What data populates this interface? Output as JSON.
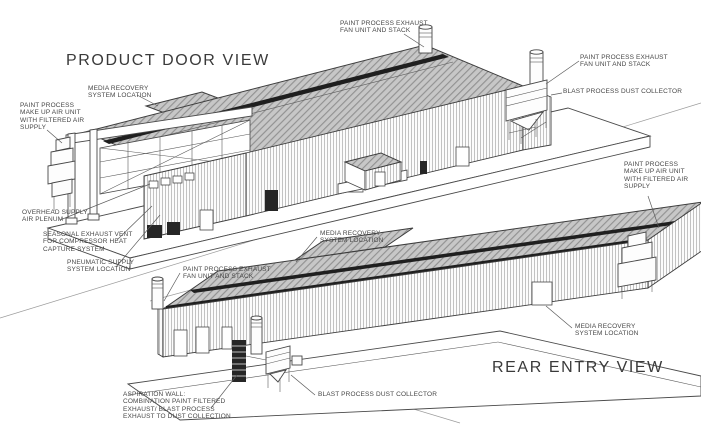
{
  "colors": {
    "background": "#ffffff",
    "line": "#4a4a4a",
    "roof_fill": "#c7c7c7",
    "ridge_band": "#1f1f1f",
    "label_text": "#474747"
  },
  "product_door_view": {
    "title": "PRODUCT DOOR VIEW",
    "labels": {
      "exhaust_fan_top": "PAINT PROCESS EXHAUST\nFAN UNIT AND STACK",
      "exhaust_fan_right": "PAINT PROCESS EXHAUST\nFAN UNIT AND STACK",
      "dust_collector": "BLAST PROCESS DUST COLLECTOR",
      "media_recovery": "MEDIA RECOVERY\nSYSTEM LOCATION",
      "make_up_air": "PAINT PROCESS\nMAKE UP AIR UNIT\nWITH FILTERED AIR\nSUPPLY",
      "overhead_supply": "OVERHEAD SUPPLY\nAIR PLENUM",
      "seasonal_exhaust": "SEASONAL EXHAUST VENT\nFOR COMPRESSOR HEAT\nCAPTURE SYSTEM",
      "pneumatic_supply": "PNEUMATIC SUPPLY\nSYSTEM LOCATION"
    }
  },
  "rear_entry_view": {
    "title": "REAR ENTRY VIEW",
    "labels": {
      "make_up_air": "PAINT PROCESS\nMAKE UP AIR UNIT\nWITH FILTERED AIR\nSUPPLY",
      "exhaust_fan": "PAINT PROCESS EXHAUST\nFAN UNIT AND STACK",
      "media_recovery_left": "MEDIA RECOVERY\nSYSTEM LOCATION",
      "media_recovery_right": "MEDIA RECOVERY\nSYSTEM LOCATION",
      "aspiration_wall": "ASPIRATION WALL:\nCOMBINATION PAINT FILTERED\nEXHAUST/ BLAST PROCESS\nEXHAUST TO DUST COLLECTION",
      "dust_collector": "BLAST PROCESS DUST COLLECTOR"
    }
  }
}
